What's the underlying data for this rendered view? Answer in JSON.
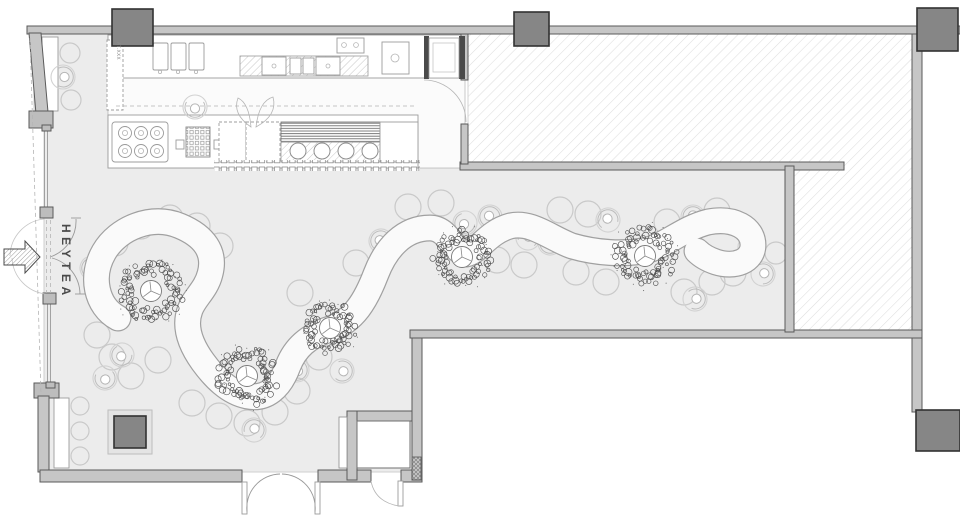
{
  "labels": {
    "brand": "HEYTEA",
    "kitchen_note": "AT.XXX"
  },
  "colors": {
    "wall": "#c6c6c6",
    "wall_edge": "#5a5a5a",
    "column": "#868686",
    "column_edge": "#323232",
    "floor": "#ececec",
    "hatch_line": "#dedede",
    "band_edge": "#a0a0a0",
    "stool": "#c9c9c9",
    "tree": "#4f4f4f",
    "text": "#4a4a4a"
  },
  "furniture": {
    "trees": [
      {
        "x": 151,
        "y": 291,
        "r": 33
      },
      {
        "x": 247,
        "y": 376,
        "r": 32
      },
      {
        "x": 330,
        "y": 328,
        "r": 27
      },
      {
        "x": 462,
        "y": 257,
        "r": 30
      },
      {
        "x": 645,
        "y": 256,
        "r": 32
      }
    ],
    "stools": [
      [
        115,
        243
      ],
      [
        141,
        226
      ],
      [
        170,
        218
      ],
      [
        197,
        226
      ],
      [
        220,
        246
      ],
      [
        97,
        335
      ],
      [
        112,
        357
      ],
      [
        131,
        376
      ],
      [
        158,
        360
      ],
      [
        192,
        403
      ],
      [
        219,
        416
      ],
      [
        247,
        423
      ],
      [
        275,
        412
      ],
      [
        297,
        391
      ],
      [
        300,
        293
      ],
      [
        319,
        357
      ],
      [
        356,
        263
      ],
      [
        408,
        207
      ],
      [
        441,
        203
      ],
      [
        560,
        210
      ],
      [
        588,
        214
      ],
      [
        667,
        222
      ],
      [
        717,
        211
      ],
      [
        497,
        260
      ],
      [
        524,
        265
      ],
      [
        576,
        272
      ],
      [
        606,
        282
      ],
      [
        684,
        292
      ],
      [
        712,
        282
      ],
      [
        733,
        273
      ],
      [
        776,
        253,
        11
      ],
      [
        80,
        406,
        9
      ],
      [
        80,
        431,
        9
      ],
      [
        80,
        456,
        9
      ],
      [
        70,
        53,
        10
      ],
      [
        71,
        100,
        10
      ]
    ],
    "persons": [
      [
        63,
        77,
        90
      ],
      [
        195,
        107,
        180
      ],
      [
        92,
        268,
        250
      ],
      [
        122,
        355,
        210
      ],
      [
        105,
        378,
        170
      ],
      [
        254,
        430,
        20
      ],
      [
        297,
        370,
        140
      ],
      [
        342,
        371,
        100
      ],
      [
        381,
        241,
        300
      ],
      [
        413,
        230,
        260
      ],
      [
        465,
        223,
        220
      ],
      [
        490,
        217,
        320
      ],
      [
        528,
        238,
        20
      ],
      [
        550,
        243,
        200
      ],
      [
        608,
        220,
        340
      ],
      [
        693,
        217,
        0
      ],
      [
        695,
        299,
        80
      ],
      [
        763,
        274,
        60
      ],
      [
        750,
        247,
        30
      ]
    ]
  },
  "kitchen": {
    "burners": [
      [
        125,
        133
      ],
      [
        141,
        133
      ],
      [
        157,
        133
      ],
      [
        125,
        151
      ],
      [
        141,
        151
      ],
      [
        157,
        151
      ]
    ],
    "tanks": [
      [
        298,
        151
      ],
      [
        322,
        151
      ],
      [
        346,
        151
      ],
      [
        370,
        151
      ]
    ]
  }
}
